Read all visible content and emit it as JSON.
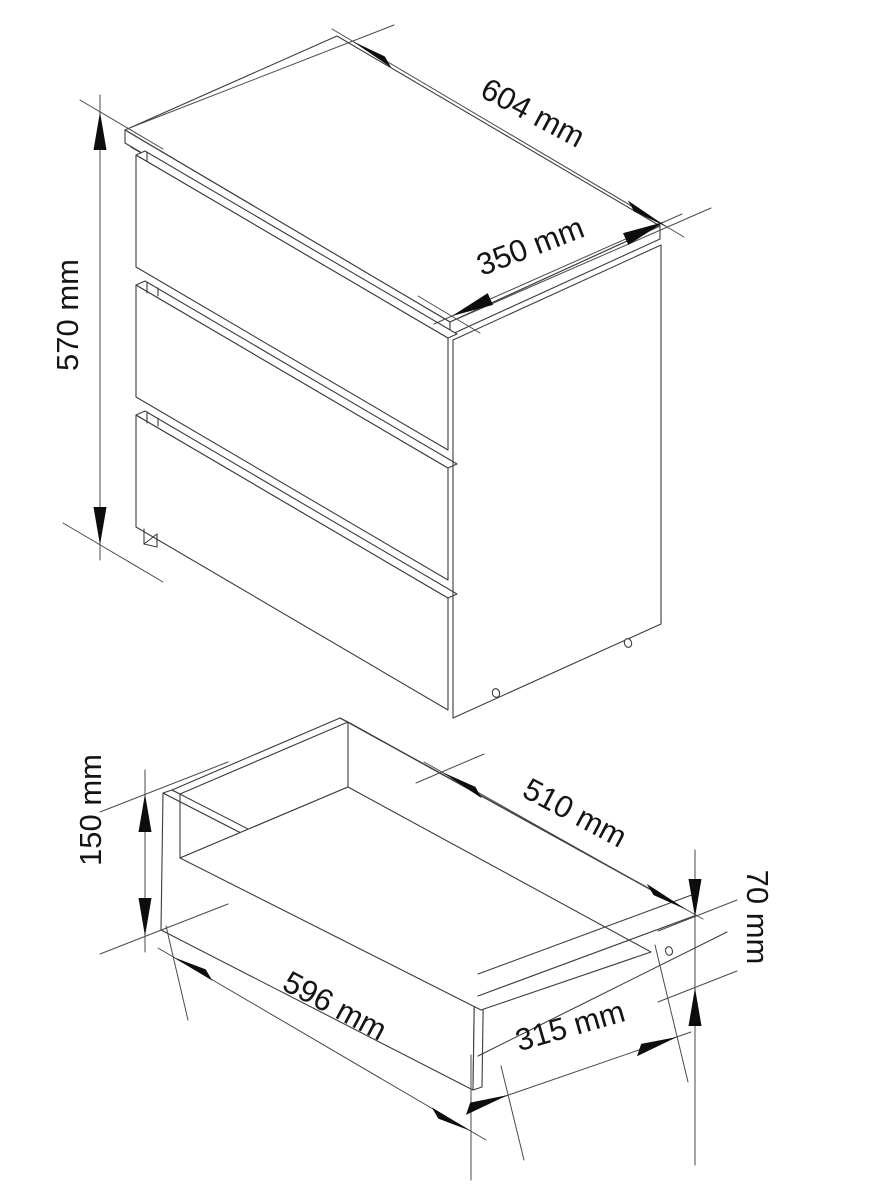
{
  "page": {
    "background_color": "#ffffff",
    "line_color": "#3c3c3c",
    "kind": "furniture technical dimension drawing"
  },
  "diagram": {
    "views": [
      {
        "id": "cabinet",
        "description": "three-drawer chest, isometric view",
        "drawer_count": 3,
        "dimensions": [
          {
            "id": "cabinet-width",
            "label": "604 mm"
          },
          {
            "id": "cabinet-depth",
            "label": "350 mm"
          },
          {
            "id": "cabinet-height",
            "label": "570 mm"
          }
        ]
      },
      {
        "id": "drawer",
        "description": "single open drawer box, isometric view",
        "dimensions": [
          {
            "id": "drawer-front-height",
            "label": "150 mm"
          },
          {
            "id": "drawer-front-width",
            "label": "596 mm"
          },
          {
            "id": "drawer-inner-width",
            "label": "510 mm"
          },
          {
            "id": "drawer-side-height",
            "label": "70 mm"
          },
          {
            "id": "drawer-depth",
            "label": "315 mm"
          }
        ]
      }
    ]
  }
}
